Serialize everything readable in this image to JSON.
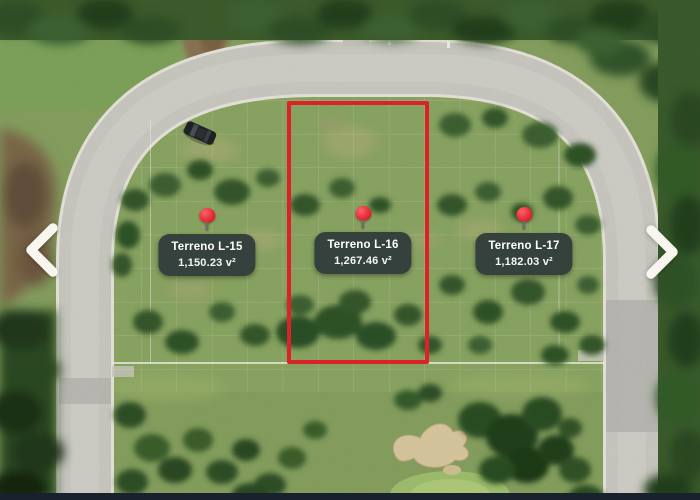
{
  "viewer": {
    "selected_lot": "Terreno L-16"
  },
  "lots": [
    {
      "name": "Terreno L-15",
      "area": "1,150.23 v²",
      "highlighted": false
    },
    {
      "name": "Terreno L-16",
      "area": "1,267.46 v²",
      "highlighted": true
    },
    {
      "name": "Terreno L-17",
      "area": "1,182.03 v²",
      "highlighted": false
    }
  ],
  "colors": {
    "lot_outline_red": "#dc2127",
    "pin_red": "#ea3540",
    "label_background": "#313d3a",
    "label_text": "#ffffff",
    "nav_arrow": "#f8f6ee",
    "bottom_bar": "#19212d"
  }
}
